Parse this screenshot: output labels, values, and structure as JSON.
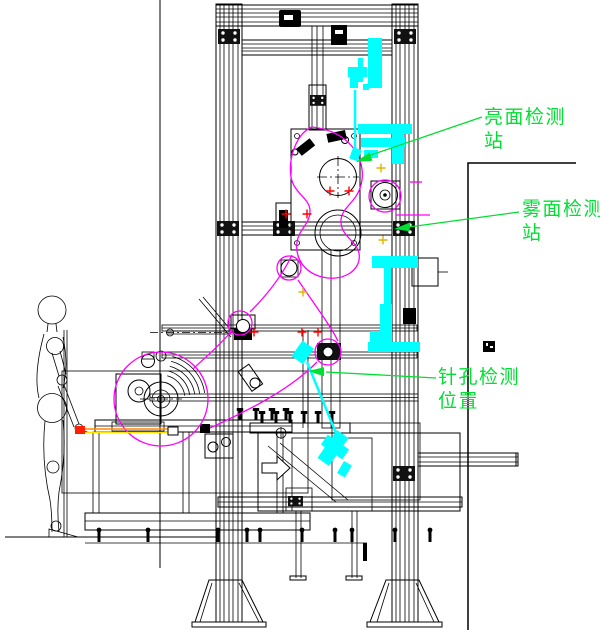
{
  "drawing_type": "CAD side-view of film inspection machine",
  "annotations": {
    "bright": {
      "line1": "亮面检测",
      "line2": "站"
    },
    "matte": {
      "line1": "雾面检测",
      "line2": "站"
    },
    "pinhole": {
      "line1": "针孔检测",
      "line2": "位置"
    }
  },
  "colors": {
    "background": "#FFFFFF",
    "line_black": "#000000",
    "annotation_green": "#00DF32",
    "film_path_magenta": "#FF00FF",
    "sensor_cyan": "#00FFFF",
    "datum_red": "#FF0000",
    "datum_yellow": "#E0B400",
    "film_strip_orange": "#FF8800",
    "film_strip_yellow": "#FFE000"
  },
  "icons": {
    "leader_arrow": "solid-triangle",
    "direction_arrow": "hollow-right-arrow",
    "datum_mark": "plus-cross",
    "block_symbol": "small-filled-square"
  }
}
